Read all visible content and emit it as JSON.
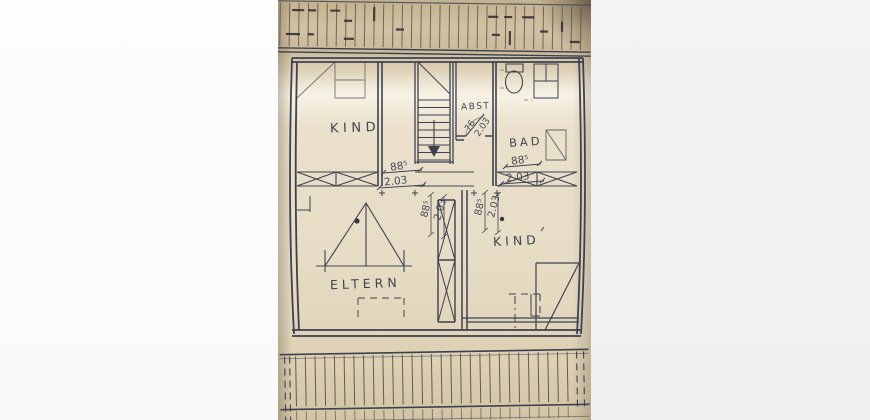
{
  "plan": {
    "rooms": {
      "kind_upper": {
        "label": "KIND"
      },
      "abst": {
        "label": "ABST"
      },
      "bad": {
        "label": "BAD"
      },
      "eltern": {
        "label": "ELTERN"
      },
      "kind_lower": {
        "label": "KIND"
      }
    },
    "dimensions": {
      "stair_door": {
        "width": "88⁵",
        "height": "2.03"
      },
      "bad_door": {
        "width": "88⁵",
        "height": "2.03"
      },
      "abst_door": {
        "width": "76",
        "height": "2.03"
      },
      "eltern_door": {
        "width": "88⁵",
        "height": "2.03"
      },
      "kind_lower_door": {
        "width": "88⁵",
        "height": "2.03"
      }
    },
    "colors": {
      "paper": "#e9dfc9",
      "ink": "#3d4251",
      "margin_left": "#fbfbfb",
      "margin_right": "#f0f1f1"
    }
  }
}
